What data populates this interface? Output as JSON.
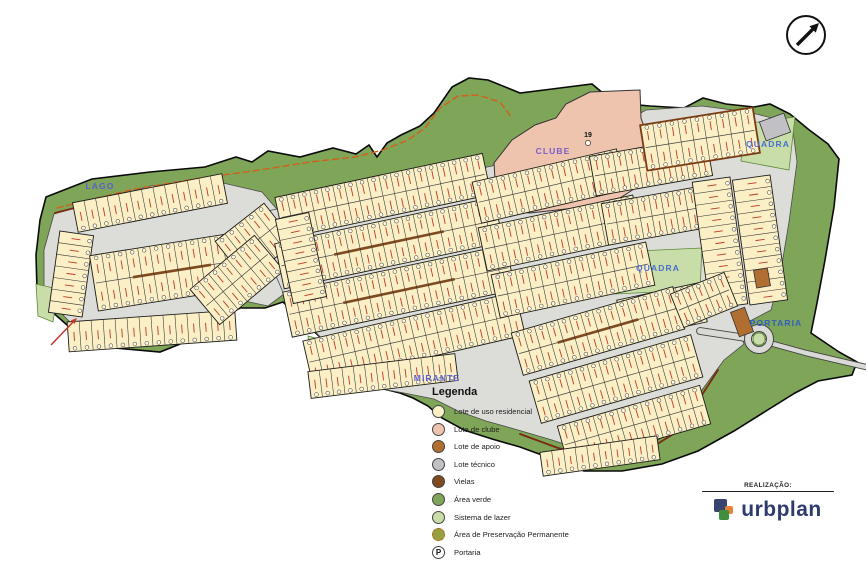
{
  "map": {
    "colors": {
      "terrain": "#7ea558",
      "terrain_edge": "#0a0a0a",
      "developed": "#dcdcd8",
      "developed_edge": "#4a4a4a",
      "lot_residential": "#fbefc5",
      "lot_clube": "#efc4ae",
      "lot_apoio": "#b06f30",
      "lot_tecnico": "#c1c1c5",
      "viela": "#7f4a1f",
      "lazer": "#c9dda9",
      "lazer_edge": "#5b8a38",
      "app_line": "#d2601a",
      "maroon": "#7b2a12",
      "road": "#d9d9d6",
      "road_edge": "#444444",
      "lot_line": "#333333",
      "tick_red": "#c0392b",
      "label_blue": "#4757c8",
      "clube_label": "#7b5cc9"
    },
    "labels": [
      {
        "id": "lago",
        "text": "LAGO",
        "x": 100,
        "y": 189,
        "color": "#5a5fcf"
      },
      {
        "id": "clube",
        "text": "CLUBE",
        "x": 553,
        "y": 154,
        "color": "#7b5cc9"
      },
      {
        "id": "quadra-top",
        "text": "QUADRA",
        "x": 768,
        "y": 147,
        "color": "#4b6fd0"
      },
      {
        "id": "quadra-mid",
        "text": "QUADRA",
        "x": 658,
        "y": 271,
        "color": "#4b6fd0"
      },
      {
        "id": "portaria",
        "text": "PORTARIA",
        "x": 776,
        "y": 326,
        "color": "#2f5fc0"
      },
      {
        "id": "mirante",
        "text": "MIRANTE",
        "x": 437,
        "y": 381,
        "color": "#5a5fcf"
      }
    ],
    "clube_number": "19",
    "terrain": [
      [
        46,
        197
      ],
      [
        92,
        179
      ],
      [
        150,
        172
      ],
      [
        205,
        167
      ],
      [
        236,
        157
      ],
      [
        252,
        162
      ],
      [
        268,
        151
      ],
      [
        300,
        157
      ],
      [
        333,
        148
      ],
      [
        356,
        154
      ],
      [
        369,
        145
      ],
      [
        377,
        157
      ],
      [
        387,
        143
      ],
      [
        401,
        135
      ],
      [
        420,
        126
      ],
      [
        434,
        113
      ],
      [
        452,
        87
      ],
      [
        469,
        78
      ],
      [
        488,
        80
      ],
      [
        520,
        93
      ],
      [
        560,
        88
      ],
      [
        592,
        84
      ],
      [
        604,
        94
      ],
      [
        616,
        103
      ],
      [
        650,
        106
      ],
      [
        684,
        108
      ],
      [
        703,
        98
      ],
      [
        726,
        104
      ],
      [
        754,
        107
      ],
      [
        770,
        104
      ],
      [
        790,
        114
      ],
      [
        808,
        129
      ],
      [
        828,
        144
      ],
      [
        839,
        159
      ],
      [
        834,
        207
      ],
      [
        825,
        260
      ],
      [
        817,
        303
      ],
      [
        811,
        333
      ],
      [
        839,
        352
      ],
      [
        857,
        362
      ],
      [
        852,
        375
      ],
      [
        818,
        381
      ],
      [
        795,
        393
      ],
      [
        766,
        411
      ],
      [
        734,
        431
      ],
      [
        698,
        451
      ],
      [
        662,
        464
      ],
      [
        622,
        471
      ],
      [
        584,
        471
      ],
      [
        550,
        458
      ],
      [
        520,
        447
      ],
      [
        492,
        439
      ],
      [
        464,
        430
      ],
      [
        442,
        418
      ],
      [
        428,
        406
      ],
      [
        413,
        398
      ],
      [
        400,
        393
      ],
      [
        380,
        388
      ],
      [
        343,
        383
      ],
      [
        337,
        353
      ],
      [
        283,
        302
      ],
      [
        265,
        308
      ],
      [
        240,
        308
      ],
      [
        218,
        320
      ],
      [
        200,
        336
      ],
      [
        160,
        352
      ],
      [
        115,
        348
      ],
      [
        75,
        332
      ],
      [
        50,
        310
      ],
      [
        37,
        290
      ],
      [
        36,
        255
      ],
      [
        40,
        220
      ]
    ],
    "developed_areas": [
      [
        [
          54,
          214
        ],
        [
          150,
          186
        ],
        [
          210,
          180
        ],
        [
          262,
          192
        ],
        [
          300,
          236
        ],
        [
          296,
          285
        ],
        [
          268,
          306
        ],
        [
          240,
          300
        ],
        [
          222,
          308
        ],
        [
          205,
          328
        ],
        [
          160,
          345
        ],
        [
          112,
          340
        ],
        [
          74,
          326
        ],
        [
          54,
          306
        ],
        [
          44,
          288
        ],
        [
          44,
          250
        ]
      ],
      [
        [
          262,
          212
        ],
        [
          425,
          180
        ],
        [
          492,
          166
        ],
        [
          498,
          162
        ],
        [
          560,
          141
        ],
        [
          603,
          134
        ],
        [
          646,
          110
        ],
        [
          702,
          106
        ],
        [
          748,
          112
        ],
        [
          792,
          123
        ],
        [
          797,
          162
        ],
        [
          789,
          222
        ],
        [
          780,
          276
        ],
        [
          771,
          310
        ],
        [
          752,
          320
        ],
        [
          736,
          326
        ],
        [
          744,
          344
        ],
        [
          724,
          360
        ],
        [
          702,
          390
        ],
        [
          692,
          418
        ],
        [
          658,
          440
        ],
        [
          622,
          452
        ],
        [
          588,
          452
        ],
        [
          552,
          440
        ],
        [
          518,
          430
        ],
        [
          486,
          421
        ],
        [
          458,
          411
        ],
        [
          434,
          399
        ],
        [
          404,
          393
        ],
        [
          376,
          388
        ],
        [
          348,
          381
        ],
        [
          340,
          357
        ],
        [
          288,
          304
        ],
        [
          270,
          262
        ]
      ]
    ],
    "clube_area": [
      [
        497,
        210
      ],
      [
        494,
        163
      ],
      [
        512,
        140
      ],
      [
        535,
        125
      ],
      [
        556,
        118
      ],
      [
        566,
        104
      ],
      [
        590,
        92
      ],
      [
        640,
        90
      ],
      [
        641,
        118
      ],
      [
        652,
        150
      ],
      [
        648,
        180
      ],
      [
        620,
        198
      ],
      [
        575,
        208
      ],
      [
        530,
        213
      ]
    ],
    "quadra_greens": [
      [
        [
          744,
          124
        ],
        [
          795,
          117
        ],
        [
          789,
          170
        ],
        [
          741,
          161
        ]
      ],
      [
        [
          616,
          252
        ],
        [
          702,
          248
        ],
        [
          700,
          290
        ],
        [
          614,
          294
        ]
      ]
    ],
    "lazer_patches": [
      [
        [
          36,
          284
        ],
        [
          58,
          289
        ],
        [
          53,
          322
        ],
        [
          38,
          316
        ]
      ],
      [
        [
          308,
          336
        ],
        [
          338,
          344
        ],
        [
          333,
          372
        ],
        [
          311,
          361
        ]
      ],
      [
        [
          404,
          346
        ],
        [
          420,
          342
        ],
        [
          424,
          368
        ],
        [
          408,
          372
        ]
      ]
    ],
    "app_line": [
      [
        57,
        208
      ],
      [
        130,
        190
      ],
      [
        200,
        178
      ],
      [
        260,
        170
      ],
      [
        310,
        162
      ],
      [
        355,
        157
      ],
      [
        383,
        150
      ],
      [
        408,
        140
      ],
      [
        425,
        128
      ],
      [
        440,
        108
      ],
      [
        458,
        96
      ],
      [
        478,
        95
      ],
      [
        500,
        102
      ],
      [
        512,
        118
      ]
    ],
    "maroon_lines": [
      [
        [
          55,
          213
        ],
        [
          125,
          195
        ],
        [
          205,
          181
        ]
      ],
      [
        [
          520,
          434
        ],
        [
          558,
          448
        ],
        [
          608,
          458
        ],
        [
          654,
          446
        ],
        [
          688,
          425
        ],
        [
          700,
          398
        ],
        [
          718,
          370
        ]
      ]
    ],
    "roads": [
      {
        "pts": [
          [
            700,
            331
          ],
          [
            733,
            336
          ],
          [
            752,
            339
          ]
        ],
        "w": 6
      },
      {
        "pts": [
          [
            766,
            342
          ],
          [
            806,
            353
          ],
          [
            866,
            367
          ]
        ],
        "w": 4.5
      }
    ],
    "roundabout": {
      "cx": 759,
      "cy": 339,
      "r_outer": 11,
      "r_inner": 6
    },
    "blocks": [
      {
        "cx": 150,
        "cy": 203,
        "w": 152,
        "h": 30,
        "rot": -11,
        "lots": 13,
        "double": false
      },
      {
        "cx": 71,
        "cy": 274,
        "w": 34,
        "h": 82,
        "rot": 8,
        "lots": 7,
        "double": false
      },
      {
        "cx": 172,
        "cy": 271,
        "w": 158,
        "h": 56,
        "rot": -9,
        "lots": 13,
        "double": true,
        "viela": true
      },
      {
        "cx": 152,
        "cy": 331,
        "w": 168,
        "h": 30,
        "rot": -4,
        "lots": 14,
        "double": false
      },
      {
        "cx": 255,
        "cy": 242,
        "w": 62,
        "h": 50,
        "rot": -38,
        "lots": 5,
        "double": true
      },
      {
        "cx": 237,
        "cy": 280,
        "w": 84,
        "h": 46,
        "rot": -40,
        "lots": 7,
        "double": true
      },
      {
        "cx": 383,
        "cy": 196,
        "w": 212,
        "h": 42,
        "rot": -12,
        "lots": 18,
        "double": true
      },
      {
        "cx": 389,
        "cy": 243,
        "w": 224,
        "h": 46,
        "rot": -12,
        "lots": 19,
        "double": true,
        "viela": true
      },
      {
        "cx": 399,
        "cy": 291,
        "w": 228,
        "h": 46,
        "rot": -12,
        "lots": 19,
        "double": true,
        "viela": true
      },
      {
        "cx": 414,
        "cy": 338,
        "w": 218,
        "h": 44,
        "rot": -13,
        "lots": 18,
        "double": true
      },
      {
        "cx": 383,
        "cy": 376,
        "w": 148,
        "h": 27,
        "rot": -7,
        "lots": 13,
        "double": false
      },
      {
        "cx": 301,
        "cy": 258,
        "w": 34,
        "h": 86,
        "rot": -12,
        "lots": 8,
        "double": false
      },
      {
        "cx": 549,
        "cy": 186,
        "w": 148,
        "h": 42,
        "rot": -13,
        "lots": 12,
        "double": true
      },
      {
        "cx": 560,
        "cy": 233,
        "w": 158,
        "h": 44,
        "rot": -12,
        "lots": 13,
        "double": true
      },
      {
        "cx": 573,
        "cy": 280,
        "w": 158,
        "h": 44,
        "rot": -12,
        "lots": 13,
        "double": true
      },
      {
        "cx": 651,
        "cy": 166,
        "w": 118,
        "h": 40,
        "rot": -10,
        "lots": 10,
        "double": true
      },
      {
        "cx": 664,
        "cy": 214,
        "w": 120,
        "h": 42,
        "rot": -10,
        "lots": 10,
        "double": true
      },
      {
        "cx": 662,
        "cy": 311,
        "w": 84,
        "h": 40,
        "rot": -12,
        "lots": 7,
        "double": true
      },
      {
        "cx": 720,
        "cy": 243,
        "w": 38,
        "h": 128,
        "rot": -8,
        "lots": 11,
        "double": false
      },
      {
        "cx": 760,
        "cy": 240,
        "w": 38,
        "h": 126,
        "rot": -8,
        "lots": 11,
        "double": false
      },
      {
        "cx": 700,
        "cy": 139,
        "w": 114,
        "h": 46,
        "rot": -9,
        "lots": 9,
        "double": true,
        "border": "#7a3a12"
      },
      {
        "cx": 598,
        "cy": 331,
        "w": 168,
        "h": 44,
        "rot": -16,
        "lots": 14,
        "double": true,
        "viela": true
      },
      {
        "cx": 616,
        "cy": 379,
        "w": 168,
        "h": 44,
        "rot": -16,
        "lots": 14,
        "double": true
      },
      {
        "cx": 634,
        "cy": 425,
        "w": 148,
        "h": 40,
        "rot": -16,
        "lots": 12,
        "double": true
      },
      {
        "cx": 600,
        "cy": 456,
        "w": 118,
        "h": 24,
        "rot": -8,
        "lots": 10,
        "double": false
      },
      {
        "cx": 704,
        "cy": 300,
        "w": 58,
        "h": 36,
        "rot": -22,
        "lots": 5,
        "double": true
      }
    ],
    "special_lots": [
      {
        "cx": 775,
        "cy": 127,
        "w": 26,
        "h": 20,
        "rot": -20,
        "fill": "#c1c1c5"
      },
      {
        "cx": 742,
        "cy": 322,
        "w": 15,
        "h": 26,
        "rot": -20,
        "fill": "#b06f30"
      },
      {
        "cx": 762,
        "cy": 278,
        "w": 14,
        "h": 18,
        "rot": -10,
        "fill": "#b06f30"
      }
    ],
    "north_arrow": {
      "cx": 806,
      "cy": 35,
      "r": 19
    },
    "red_arrow": {
      "x1": 51,
      "y1": 345,
      "x2": 77,
      "y2": 318
    }
  },
  "legend": {
    "title": "Legenda",
    "items": [
      {
        "id": "residencial",
        "label": "Lote de uso residencial",
        "color": "#fbefc5",
        "type": "circle"
      },
      {
        "id": "clube",
        "label": "Lote de clube",
        "color": "#efc4ae",
        "type": "circle"
      },
      {
        "id": "apoio",
        "label": "Lote de apoio",
        "color": "#b06f30",
        "type": "circle"
      },
      {
        "id": "tecnico",
        "label": "Lote técnico",
        "color": "#c1c1c5",
        "type": "circle"
      },
      {
        "id": "vielas",
        "label": "Vielas",
        "color": "#7f4a1f",
        "type": "circle"
      },
      {
        "id": "area-verde",
        "label": "Área verde",
        "color": "#7ea558",
        "type": "circle"
      },
      {
        "id": "sistema-lazer",
        "label": "Sistema de lazer",
        "color": "#c9dda9",
        "type": "circle"
      },
      {
        "id": "app",
        "label": "Área de Preservação Permanente",
        "color": "#97a03f",
        "type": "app"
      },
      {
        "id": "portaria",
        "label": "Portaria",
        "color": "#ffffff",
        "type": "portaria",
        "glyph": "P"
      }
    ]
  },
  "credits": {
    "realizacao_label": "REALIZAÇÃO:",
    "brand": "urbplan"
  }
}
